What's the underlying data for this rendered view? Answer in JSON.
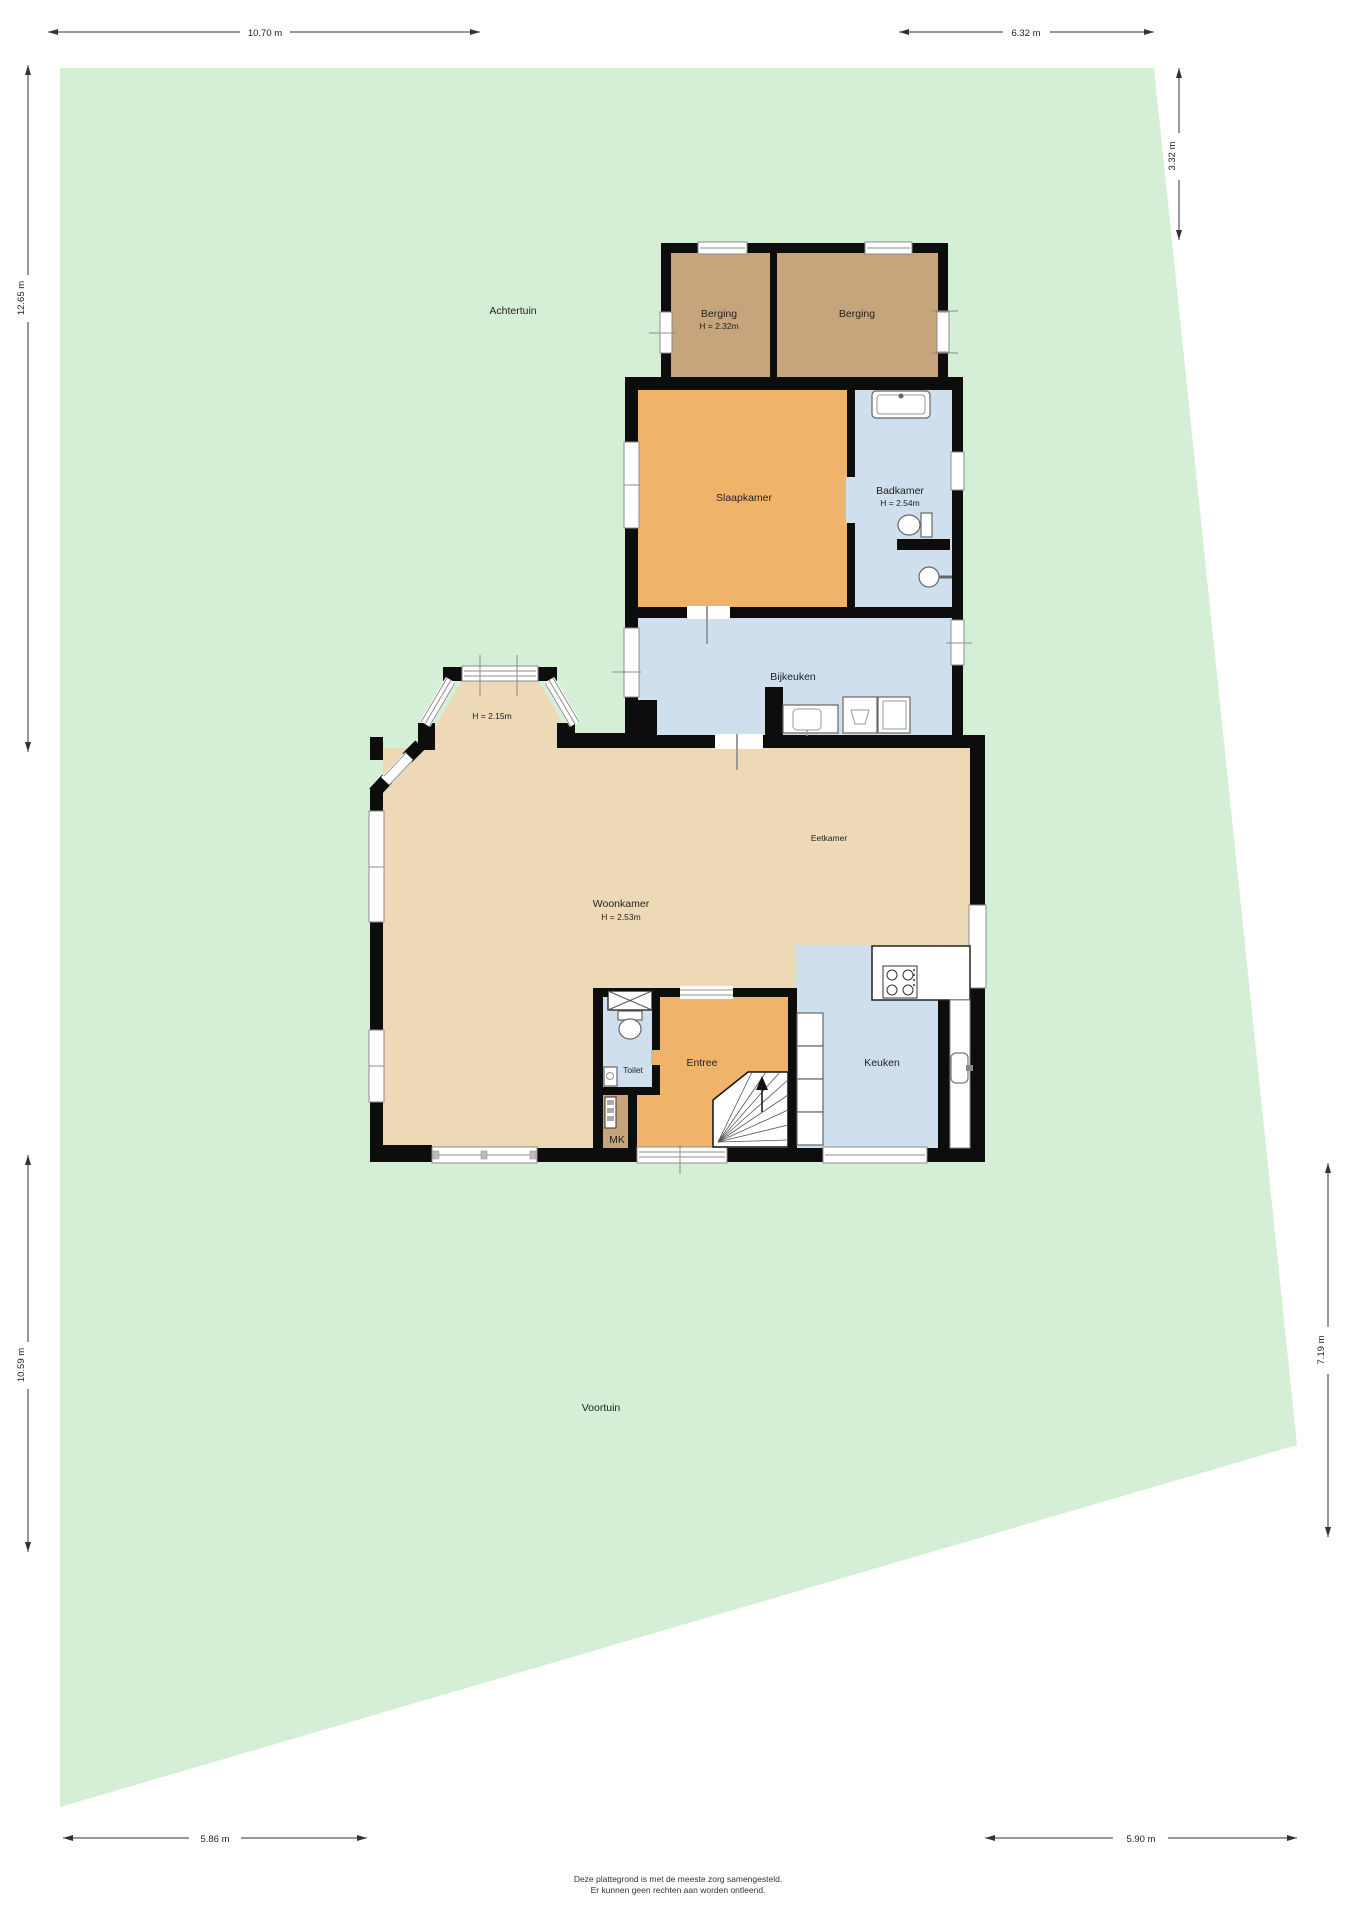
{
  "garden": {
    "back_label": "Achtertuin",
    "front_label": "Voortuin"
  },
  "rooms": {
    "berging_left": {
      "name": "Berging",
      "height": "H = 2.32m"
    },
    "berging_right": {
      "name": "Berging"
    },
    "slaapkamer": {
      "name": "Slaapkamer"
    },
    "badkamer": {
      "name": "Badkamer",
      "height": "H = 2.54m"
    },
    "bijkeuken": {
      "name": "Bijkeuken"
    },
    "erker": {
      "height": "H = 2.15m"
    },
    "woonkamer": {
      "name": "Woonkamer",
      "height": "H = 2.53m"
    },
    "eetkamer": {
      "name": "Eetkamer"
    },
    "toilet": {
      "name": "Toilet"
    },
    "entree": {
      "name": "Entree"
    },
    "keuken": {
      "name": "Keuken"
    },
    "meterkast": {
      "name": "MK"
    }
  },
  "dimensions": {
    "top_left": "10.70 m",
    "top_right": "6.32 m",
    "right_upper": "3.32 m",
    "left_upper": "12.65 m",
    "left_lower": "10.59 m",
    "right_lower": "7.19 m",
    "bottom_left": "5.86 m",
    "bottom_right": "5.90 m"
  },
  "footer": {
    "line1": "Deze plattegrond is met de meeste zorg samengesteld.",
    "line2": "Er kunnen geen rechten aan worden ontleend."
  },
  "colors": {
    "garden": "#d5efd6",
    "living": "#eed9b6",
    "orange_room": "#efb469",
    "wet_room": "#cfdfee",
    "storage": "#c6a57c",
    "wall": "#0d0d0d"
  }
}
